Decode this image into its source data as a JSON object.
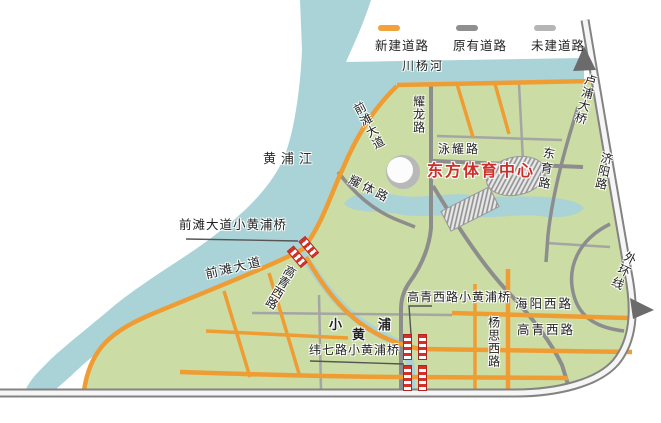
{
  "legend": {
    "items": [
      {
        "label": "新建道路",
        "color": "#f0a23c"
      },
      {
        "label": "原有道路",
        "color": "#8f8f8f"
      },
      {
        "label": "未建道路",
        "color": "#b5b5b5"
      }
    ]
  },
  "waterways": {
    "huangpu_river": "黄浦江",
    "chuanyang_river": "川杨河",
    "xiao_huangpu": {
      "char1": "小",
      "char2": "黄",
      "char3": "浦"
    }
  },
  "poi": {
    "sports_center": "东方体育中心"
  },
  "roads": {
    "qiantan_avenue": "前滩大道",
    "yaolong_road": "耀龙路",
    "yongyao_road": "泳耀路",
    "dongyu_road": "东育路",
    "yaoti_road": "耀体路",
    "gaoqing_west_road": "高青西路",
    "haiyang_west_road": "海阳西路",
    "yangsi_west_road": "杨思西路",
    "jiyang_road": "济阳路",
    "lupu_bridge": "卢浦大桥",
    "outer_ring_line": "外环线"
  },
  "bridges": {
    "qiantan_bridge": "前滩大道小黄浦桥",
    "gaoqing_bridge": "高青西路小黄浦桥",
    "weiqi_bridge": "纬七路小黄浦桥"
  },
  "colors": {
    "new_road": "#ef9c33",
    "existing_road": "#8d8d8d",
    "ring_road": "#838383",
    "water": "#a9d3d7",
    "land": "#cbdca4",
    "poi_text": "#cf2d27",
    "bridge_red": "#d43028"
  }
}
